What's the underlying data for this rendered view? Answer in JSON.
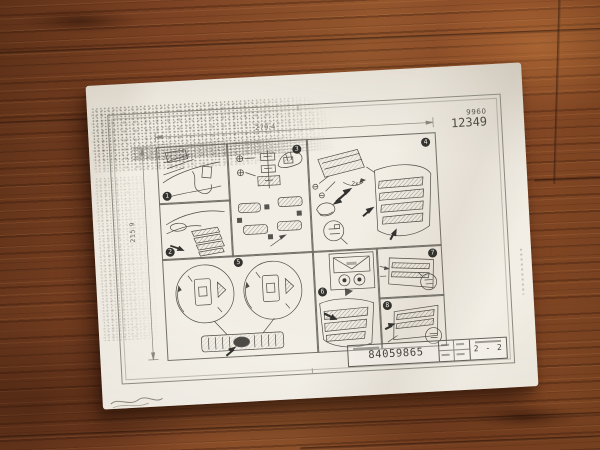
{
  "sheet": {
    "code_small": "9960",
    "code_large": "12349",
    "dim_width": "279.4",
    "dim_height": "215.9",
    "qty_label": "2x",
    "steps": [
      "1",
      "2",
      "3",
      "4",
      "5",
      "6",
      "7",
      "8"
    ],
    "title_block": {
      "part_number": "84059865",
      "sheet_number": "2 - 2"
    }
  },
  "colors": {
    "floor_wood": "#8a4c28",
    "paper": "#ece8df",
    "ink": "#4d4b45"
  }
}
